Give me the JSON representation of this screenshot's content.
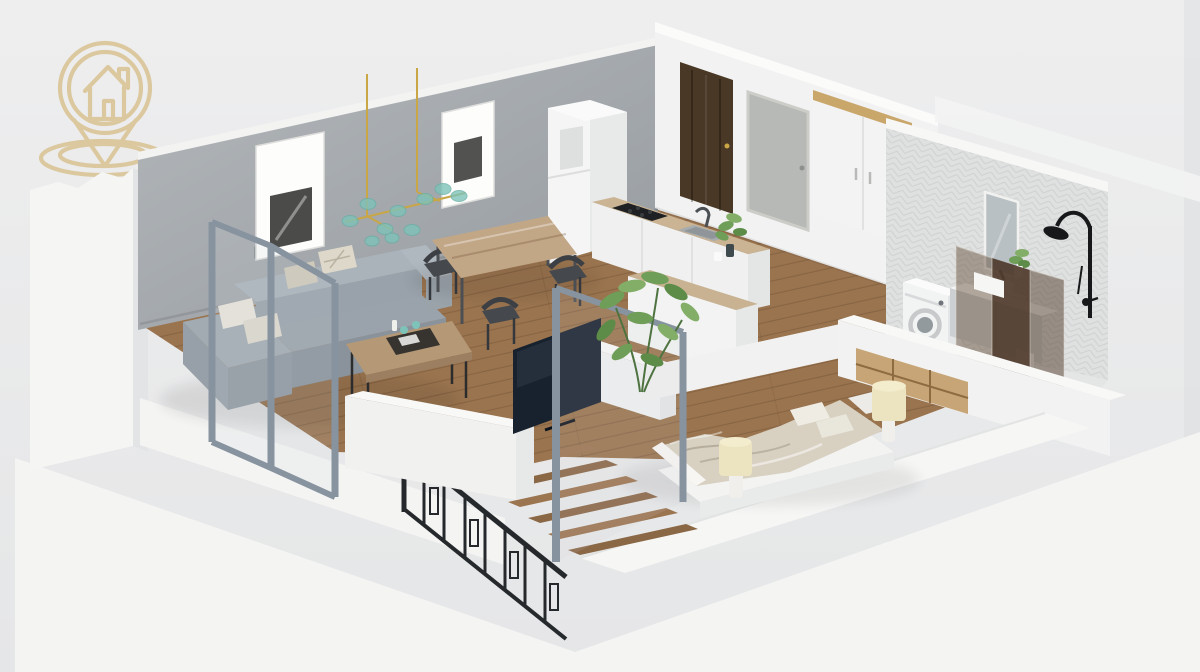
{
  "meta": {
    "type": "3d-isometric-floor-plan-render",
    "description": "3D isometric cutaway floor plan of a one-bedroom apartment with living room, dining area, kitchen, hallway, bedroom, bathroom and a staircase, rendered on a light gray background with a gold house-in-location-pin watermark logo in the top left corner"
  },
  "logo": {
    "name": "house-location-pin-logo",
    "elements": [
      "outer-ellipse-base",
      "inner-ellipse-base",
      "location-pin-circle",
      "house-with-chimney-and-door"
    ],
    "color": "#d8c08c"
  },
  "palette": {
    "bg_top": "#eeeeef",
    "bg_bottom": "#e5e6e7",
    "platform": "#f4f4f3",
    "wall_white": "#f1f2f1",
    "wall_gray_light": "#b3b7ba",
    "wall_gray_dark": "#969ba0",
    "wood_floor": "#9a744f",
    "wood_counter": "#cbb494",
    "wood_shelf": "#c7a576",
    "sofa_gray": "#9aa3ab",
    "pillow_cream": "#ddd8ca",
    "teal_accent": "#7ec3b9",
    "gold_accent": "#d8c08c",
    "gold_stem": "#c9a646",
    "door_brown": "#4a3826",
    "glass_brown": "#5a4330",
    "tile_white": "#dfe0e0",
    "metal_dark": "#26292c",
    "frame_blue": "#8893a0",
    "plant_green": "#6f9e58",
    "lamp_cream": "#ece4c1",
    "tv_navy": "#18222f"
  },
  "scene": {
    "rooms": [
      {
        "name": "living-room",
        "furniture": [
          "gray-corner-sofa",
          "cream-pillows",
          "wood-coffee-table",
          "decor-tray",
          "teal-chandelier",
          "two-framed-pictures",
          "gray-accent-wall",
          "glass-partition"
        ]
      },
      {
        "name": "dining-area",
        "furniture": [
          "wood-dining-table",
          "four-dark-chairs"
        ]
      },
      {
        "name": "kitchen",
        "furniture": [
          "fridge",
          "wood-countertop",
          "black-cooktop",
          "sink-with-faucet",
          "bar-peninsula",
          "potted-plant"
        ]
      },
      {
        "name": "hallway",
        "furniture": [
          "entry-door-dark",
          "interior-door-gray",
          "wardrobe-with-oak-top",
          "tall-plant"
        ]
      },
      {
        "name": "bedroom",
        "furniture": [
          "double-bed-beige-duvet",
          "two-cream-lamps",
          "wood-shelf-niche",
          "tv-navy"
        ]
      },
      {
        "name": "bathroom",
        "furniture": [
          "herringbone-tile-wall",
          "washing-machine",
          "vanity-with-sink",
          "mirror",
          "toilet",
          "black-shower-set",
          "brown-glass-partition",
          "shelf-plant"
        ]
      },
      {
        "name": "staircase",
        "furniture": [
          "wood-steps",
          "dark-metal-railing"
        ]
      }
    ]
  }
}
